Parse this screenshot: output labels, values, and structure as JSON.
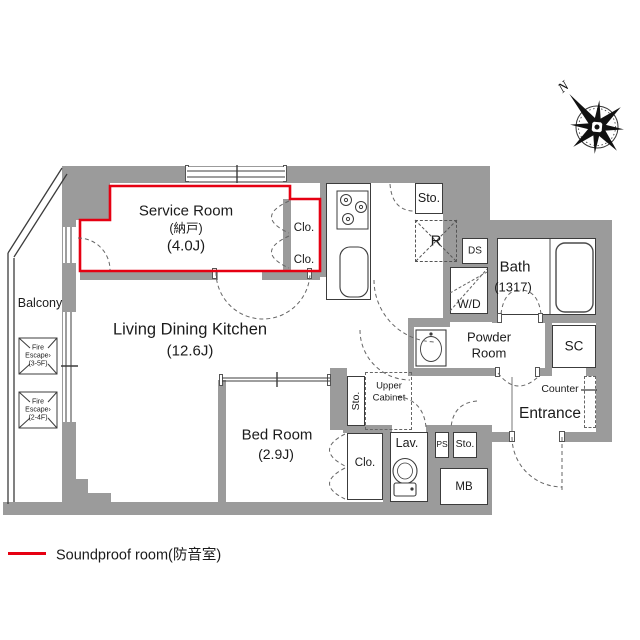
{
  "plan": {
    "rooms": {
      "service_room": {
        "name": "Service Room",
        "sub": "(納戸)",
        "size": "(4.0J)"
      },
      "closet1": "Clo.",
      "closet2": "Clo.",
      "ldk": {
        "name": "Living Dining Kitchen",
        "size": "(12.6J)"
      },
      "bedroom": {
        "name": "Bed Room",
        "size": "(2.9J)"
      },
      "bath": {
        "name": "Bath",
        "size": "(1317)"
      },
      "powder_room": {
        "line1": "Powder",
        "line2": "Room"
      },
      "entrance": "Entrance",
      "counter": "Counter",
      "sc": "SC",
      "sto_top": "Sto.",
      "sto_mid": "Sto.",
      "sto_small": "Sto.",
      "refrigerator": "R",
      "ds": "DS",
      "wd": "W/D",
      "upper_cabinet": {
        "line1": "Upper",
        "line2": "Cabinet"
      },
      "lavatory": "Lav.",
      "ps": "PS",
      "mb": "MB",
      "closet_bed": "Clo.",
      "balcony": "Balcony",
      "fire_escape_1": {
        "line1": "Fire",
        "line2": "Escape›",
        "line3": "(3-5F)"
      },
      "fire_escape_2": {
        "line1": "Fire",
        "line2": "Escape›",
        "line3": "(2-4F)"
      }
    },
    "compass": {
      "north_label": "N"
    },
    "legend": {
      "soundproof": "Soundproof room(防音室)"
    },
    "colors": {
      "soundproof_red": "#e60012",
      "wall_gray": "#9b9b9b"
    }
  }
}
